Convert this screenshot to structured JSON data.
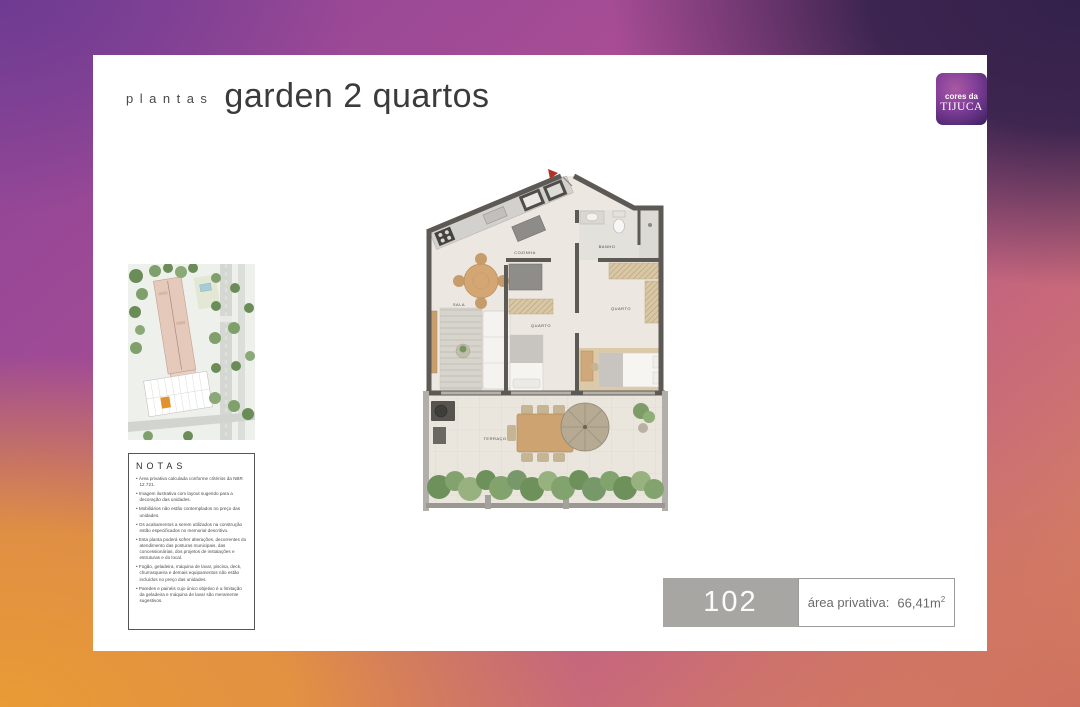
{
  "header": {
    "title_small": "plantas",
    "title_large": "garden 2 quartos"
  },
  "logo": {
    "line1": "cores da",
    "line2": "TIJUCA"
  },
  "notes": {
    "title": "NOTAS",
    "items": [
      "Área privativa calculada conforme critérios da NBR 12.721.",
      "Imagem ilustrativa com layout sugerido para a decoração das unidades.",
      "Mobiliários não estão contemplados no preço das unidades.",
      "Os acabamentos a serem utilizados na construção estão especificados no memorial descritivo.",
      "Esta planta poderá sofrer alterações, decorrentes do atendimento das posturas municipais, das concessionárias, dos projetos de instalações e estruturas e do local.",
      "Fogão, geladeira, máquina de lavar, piscina, deck, churrasqueira e demais equipamentos não estão incluídos no preço das unidades.",
      "Paredes e painéis cujo único objetivo é a limitação da geladeira e máquina de lavar são meramente sugestivos."
    ]
  },
  "floorplan": {
    "labels": {
      "cozinha": "COZINHA",
      "banho": "BANHO",
      "quarto_direita": "QUARTO",
      "quarto_meio": "QUARTO",
      "sala": "SALA",
      "terraco": "TERRAÇO"
    }
  },
  "unit": {
    "number": "102",
    "area_label": "área privativa:",
    "area_value": "66,41m",
    "area_sup": "2"
  },
  "colors": {
    "logo_purple": "#532a74",
    "highlight_orange": "#e2912f",
    "unit_box_gray": "#a7a6a3",
    "background_purple": "#6e3b92",
    "background_orange": "#e99b35"
  }
}
